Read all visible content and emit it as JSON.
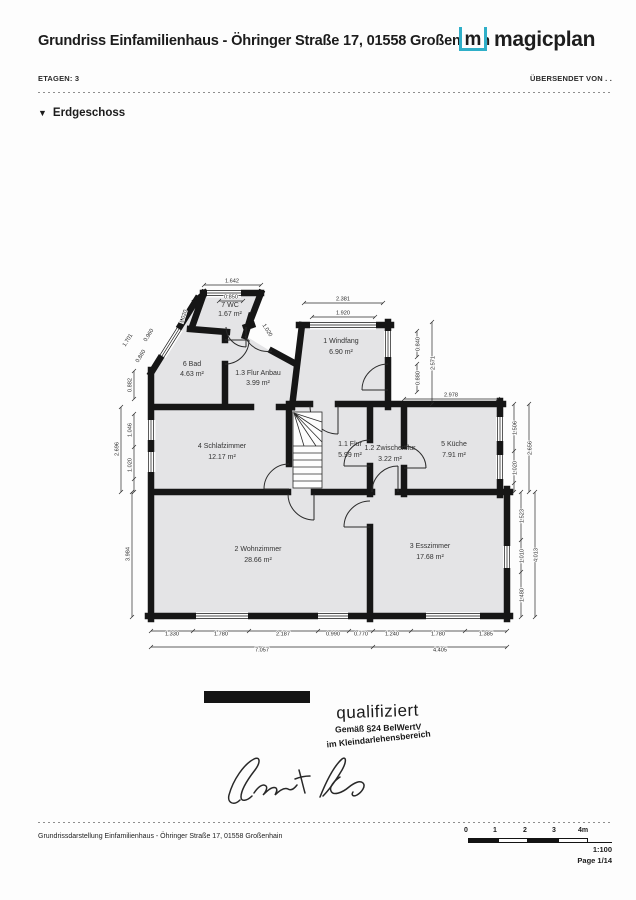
{
  "header": {
    "title": "Grundriss Einfamilienhaus - Öhringer Straße 17, 01558 Großenhain",
    "etagen": "ETAGEN: 3",
    "sent_by": "ÜBERSENDET VON . .",
    "collapse_icon": "▼",
    "floor_section": "Erdgeschoss"
  },
  "logo": {
    "m": "m",
    "name": "magicplan"
  },
  "plan": {
    "rooms": [
      {
        "name": "7 WC",
        "area": "1.67 m²"
      },
      {
        "name": "6 Bad",
        "area": "4.63 m²"
      },
      {
        "name": "1.3 Flur Anbau",
        "area": "3.99 m²"
      },
      {
        "name": "1 Windfang",
        "area": "6.90 m²"
      },
      {
        "name": "4 Schlafzimmer",
        "area": "12.17 m²"
      },
      {
        "name": "1.1 Flur",
        "area": "5.99 m²"
      },
      {
        "name": "1.2 Zwischenflur",
        "area": "3.22 m²"
      },
      {
        "name": "5 Küche",
        "area": "7.91 m²"
      },
      {
        "name": "2 Wohnzimmer",
        "area": "28.66 m²"
      },
      {
        "name": "3 Esszimmer",
        "area": "17.68 m²"
      }
    ],
    "dims": {
      "wc_top_outer": "1.642",
      "wc_top_inner": "0.850",
      "wc_left": "1.020",
      "wc_right": "1.020",
      "windfang_top_outer": "2.381",
      "windfang_top_inner": "1.920",
      "windfang_win": "0.840",
      "windfang_door": "0.880",
      "windfang_right_outer": "2.571",
      "kueche_top": "2.978",
      "kueche_win1": "1.506",
      "kueche_win2": "1.020",
      "kueche_right_outer": "2.656",
      "ess_right1": "1.523",
      "ess_right2": "1.010",
      "ess_right3": "1.480",
      "ess_right_outer": "4.013",
      "bad_diag_outer": "1.701",
      "bad_diag1": "0.960",
      "bad_diag2": "0.860",
      "bad_left": "0.882",
      "schlaf_win1": "1.046",
      "schlaf_win2": "1.020",
      "schlaf_left_outer": "2.696",
      "wohn_left": "3.984",
      "bottom1": "1.330",
      "bottom2": "1.780",
      "bottom3": "2.187",
      "bottom4": "0.990",
      "bottom5": "0.770",
      "bottom6": "1.240",
      "bottom7": "1.780",
      "bottom8": "1.385",
      "bottom_total_left": "7.057",
      "bottom_total_right": "4.405"
    }
  },
  "stamp": {
    "line1": "qualifiziert",
    "line2": "Gemäß §24 BelWertV",
    "line3": "im Kleindarlehensbereich"
  },
  "footer": {
    "caption": "Grundrissdarstellung Einfamilienhaus - Öhringer Straße 17, 01558 Großenhain",
    "scale_ticks": [
      "0",
      "1",
      "2",
      "3",
      "4m"
    ],
    "scale": "1:100",
    "page": "Page 1/14"
  },
  "colors": {
    "accent": "#2fafc8",
    "wall": "#161616",
    "room_fill": "#e4e4e6"
  }
}
